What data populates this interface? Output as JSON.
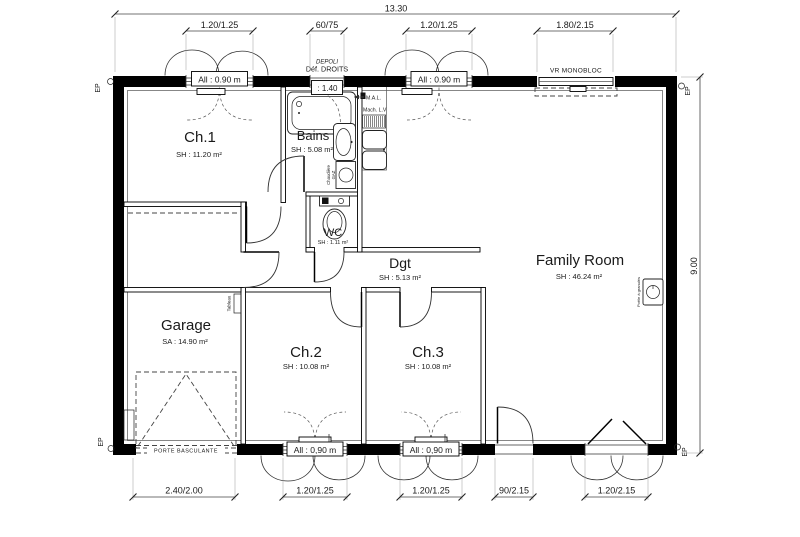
{
  "rooms": [
    {
      "name": "Ch.1",
      "area": "SH : 11.20 m²"
    },
    {
      "name": "Bains",
      "area": "SH : 5.08 m²"
    },
    {
      "name": "WC",
      "area": "SH : 1.11 m²"
    },
    {
      "name": "Dgt",
      "area": "SH : 5.13 m²"
    },
    {
      "name": "Family Room",
      "area": "SH : 46.24 m²"
    },
    {
      "name": "Garage",
      "area": "SA : 14.90 m²"
    },
    {
      "name": "Ch.2",
      "area": "SH : 10.08 m²"
    },
    {
      "name": "Ch.3",
      "area": "SH : 10.08 m²"
    }
  ],
  "dims": {
    "overall_w": "13.30",
    "overall_h": "9.00",
    "top": [
      "1.20/1.25",
      "60/75",
      "1.20/1.25",
      "1.80/2.15"
    ],
    "bottom": [
      "2.40/2.00",
      "1.20/1.25",
      "1.20/1.25",
      "90/2.15",
      "1.20/2.15"
    ]
  },
  "sills": {
    "top1": "All : 0.90 m",
    "top2": "All : 0.90 m",
    "bot1": "All : 0,90 m",
    "bot2": "All : 0,90 m"
  },
  "notes": {
    "depoli": "DEPOLI",
    "def_droits": "Déf. DROITS",
    "depoli_h": ": 1.40",
    "vr": "VR MONOBLOC",
    "porte_basc": "PORTE BASCULANTE",
    "mal": "M.A.L.",
    "mach_lv": "Mach. L.V",
    "chaudiere1": "Chaudière",
    "chaudiere2": "GAZ",
    "poele": "Poêle à granulés",
    "tableau": "Tableau",
    "ep": "EP"
  },
  "colors": {
    "wall": "#000000",
    "line": "#1a1a1a",
    "background": "#ffffff"
  }
}
